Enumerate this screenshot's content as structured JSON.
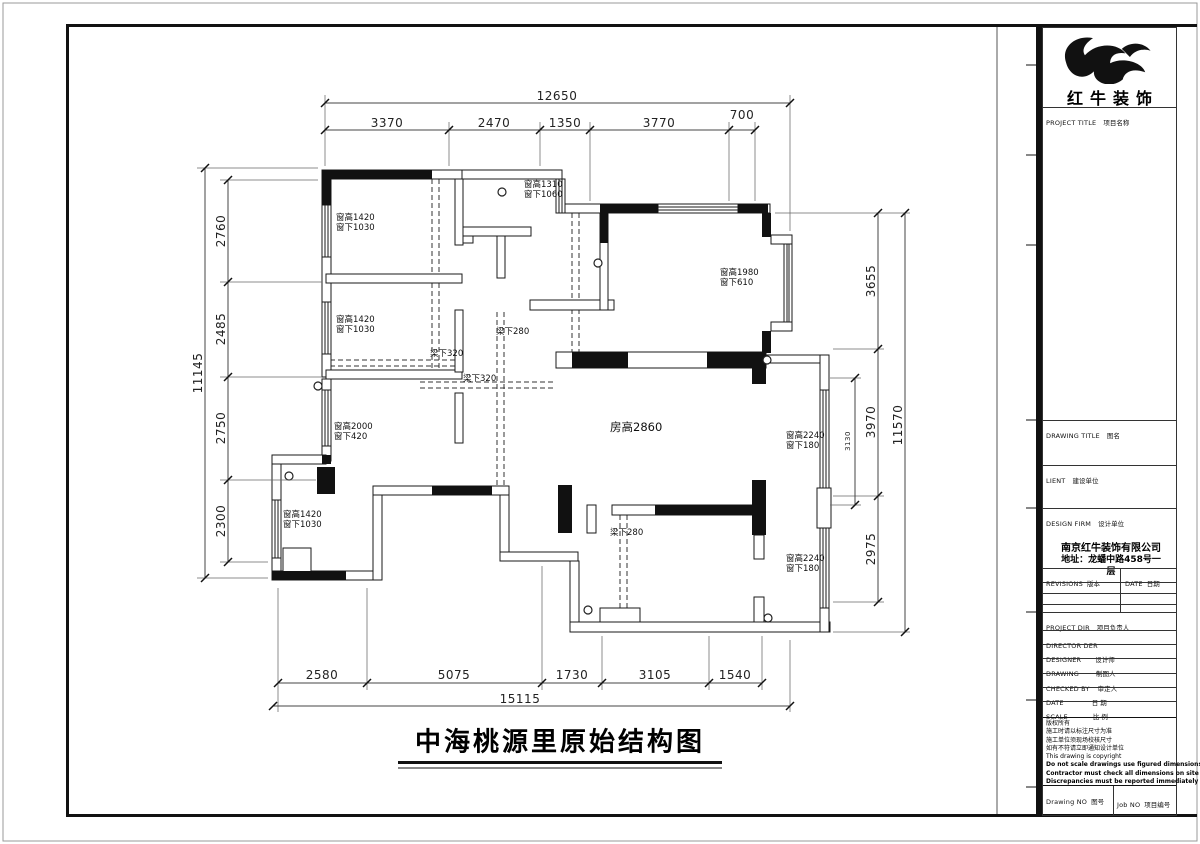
{
  "drawing_title": "中海桃源里原始结构图",
  "dims": {
    "top": {
      "total": "12650",
      "segs": [
        "3370",
        "2470",
        "1350",
        "3770",
        "700"
      ]
    },
    "left": {
      "total": "11145",
      "segs": [
        "2760",
        "2485",
        "2750",
        "2300"
      ]
    },
    "right": {
      "total": "11570",
      "segs": [
        "3655",
        "3970",
        "2975"
      ],
      "inner": "3130"
    },
    "bottom": {
      "total": "15115",
      "segs": [
        "2580",
        "5075",
        "1730",
        "3105",
        "1540"
      ]
    }
  },
  "annotations": {
    "windows": [
      {
        "h": "窗高1420",
        "b": "窗下1030"
      },
      {
        "h": "窗高1310",
        "b": "窗下1060"
      },
      {
        "h": "窗高1420",
        "b": "窗下1030"
      },
      {
        "h": "窗高1980",
        "b": "窗下610"
      },
      {
        "h": "窗高2000",
        "b": "窗下420"
      },
      {
        "h": "窗高2240",
        "b": "窗下180"
      },
      {
        "h": "窗高1420",
        "b": "窗下1030"
      },
      {
        "h": "窗高2240",
        "b": "窗下180"
      }
    ],
    "beams": [
      "梁下280",
      "梁下320",
      "梁下320",
      "梁下280"
    ],
    "room_height": "房高2860"
  },
  "title_block": {
    "logo_text": "红牛装饰",
    "project_title": {
      "en": "PROJECT TITLE",
      "zh": "项目名称"
    },
    "drawing_title_label": {
      "en": "DRAWING TITLE",
      "zh": "图名"
    },
    "client": {
      "en": "LIENT",
      "zh": "建设单位"
    },
    "design_firm": {
      "en": "DESIGN FIRM",
      "zh": "设计单位"
    },
    "firm_name": "南京红牛装饰有限公司",
    "firm_address_1": "地址：龙蟠中路458号一",
    "firm_address_2": "层",
    "revisions": {
      "en": "REVISIONS",
      "zh": "版本"
    },
    "rev_date": {
      "en": "DATE",
      "zh": "日期"
    },
    "project_dir": {
      "en": "PROJECT DIR",
      "zh": "项目负责人"
    },
    "director": {
      "en": "DIRECTOR DER",
      "zh": ""
    },
    "designer": {
      "en": "DESIGNER",
      "zh": "设计师"
    },
    "drawing": {
      "en": "DRAWING",
      "zh": "制图人"
    },
    "checked_by": {
      "en": "CHECKED BY",
      "zh": "审定人"
    },
    "date": {
      "en": "DATE",
      "zh": "日 期"
    },
    "scale": {
      "en": "SCALE",
      "zh": "比 例"
    },
    "notes": [
      "版权所有",
      "施工时请以标注尺寸为准",
      "施工单位须现场校核尺寸",
      "如有不符请立即通知设计单位",
      "This drawing is copyright",
      "Do not scale drawings use figured dimensions only",
      "Contractor must check all dimensions on site",
      "Discrepancies must be reported immediately to architects"
    ],
    "drawing_no": {
      "en": "Drawing NO",
      "zh": "图号"
    },
    "job_no": {
      "en": "Job NO",
      "zh": "项目编号"
    }
  }
}
